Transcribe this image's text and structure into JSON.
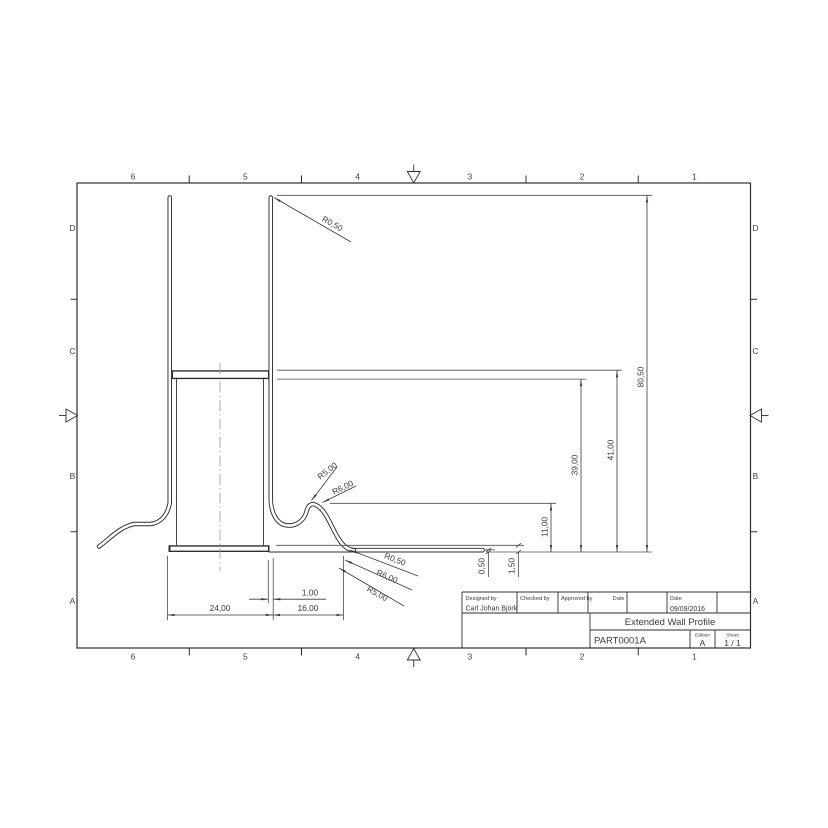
{
  "sheet": {
    "border": {
      "cols": [
        "6",
        "5",
        "4",
        "3",
        "2",
        "1"
      ],
      "rows": [
        "D",
        "C",
        "B",
        "A"
      ]
    },
    "title_block": {
      "designed_by_label": "Designed by",
      "designed_by": "Carl Johan Björk",
      "checked_by_label": "Checked by",
      "approved_by_label": "Approved by",
      "date_label": "Date",
      "date2_label": "Date",
      "date_value": "09/09/2016",
      "title": "Extended Wall Profile",
      "part_number": "PART0001A",
      "edition_label": "Edition",
      "edition": "A",
      "sheet_label": "Sheet",
      "sheet_number": "1 / 1"
    },
    "dimensions": {
      "d80_50": "80,50",
      "d41": "41,00",
      "d39": "39,00",
      "d11": "11,00",
      "d1_50": "1,50",
      "d0_50": "0,50",
      "d24": "24,00",
      "d16": "16,00",
      "d1": "1,00",
      "r_top": "R0,50",
      "r5_mid": "R5,00",
      "r6_mid": "R6,00",
      "r0_bot": "R0,50",
      "r6_bot": "R6,00",
      "r5_bot": "R5,00"
    },
    "colors": {
      "line": "#2e2e2e",
      "thin_line": "#4d4d4d",
      "centerline": "#999999"
    }
  }
}
